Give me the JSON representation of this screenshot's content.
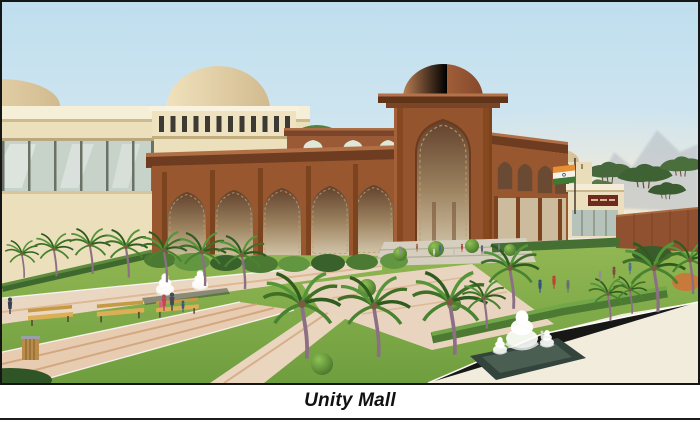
{
  "figure": {
    "caption": "Unity Mall",
    "kind": "architectural rendering",
    "flag_icon": "indian-flag",
    "colors": {
      "sky": "#c6e1ef",
      "terracotta": "#98572f",
      "dome_brown": "#a05e39",
      "cream_stone": "#ecdfbb",
      "lawn_green": "#7fae48",
      "path_paving": "#e9d4bd",
      "caption_text": "#111111",
      "frame_border": "#161616"
    }
  }
}
